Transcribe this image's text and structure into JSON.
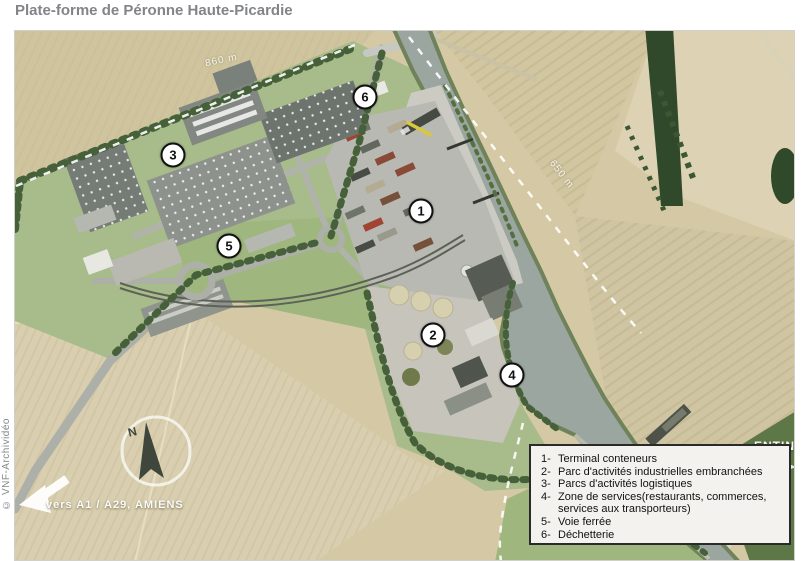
{
  "title": "Plate-forme de Péronne Haute-Picardie",
  "credit": "© VNF-Archividéo",
  "map": {
    "compass_north": "N",
    "distance_label_nw": "860 m",
    "distance_label_ne": "650 m",
    "direction_sw": "vers A1 / A29, AMIENS",
    "direction_ne_partial": "ENTIN",
    "markers": [
      {
        "number": "1"
      },
      {
        "number": "2"
      },
      {
        "number": "3"
      },
      {
        "number": "4"
      },
      {
        "number": "5"
      },
      {
        "number": "6"
      }
    ]
  },
  "legend": {
    "items": [
      {
        "num": "1-",
        "label": "Terminal conteneurs"
      },
      {
        "num": "2-",
        "label": "Parc d'activités industrielles embranchées"
      },
      {
        "num": "3-",
        "label": "Parcs d'activités logistiques"
      },
      {
        "num": "4-",
        "label": "Zone de services(restaurants, commerces, services aux transporteurs)"
      },
      {
        "num": "5-",
        "label": "Voie ferrée"
      },
      {
        "num": "6-",
        "label": "Déchetterie"
      }
    ]
  },
  "colors": {
    "title_text": "#828487",
    "water": "#9aa69f",
    "field_tan": "#d5c9a5",
    "platform_green": "#a8bb8a",
    "tree_green": "#46613a",
    "concrete": "#c9c9c2",
    "legend_bg": "#f3f2ee",
    "legend_border": "#2a2a2a",
    "marker_bg": "#ffffff",
    "marker_border": "#111111"
  }
}
